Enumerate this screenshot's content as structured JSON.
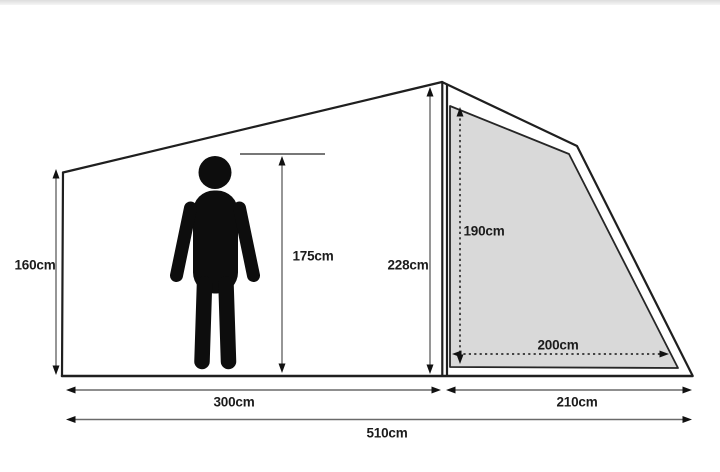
{
  "diagram": {
    "title": "tent-dimension-diagram",
    "colors": {
      "background": "#ffffff",
      "outline": "#1f1f1f",
      "panel_fill": "#d9d9d9",
      "measure_line": "#6a6a6a",
      "arrowhead": "#111111",
      "text": "#1c1c1c"
    },
    "measurements": {
      "left_wall_height": "160cm",
      "person_height": "175cm",
      "peak_height": "228cm",
      "porch_door_height": "190cm",
      "porch_door_width": "200cm",
      "main_section_length": "300cm",
      "porch_section_length": "210cm",
      "total_length": "510cm"
    }
  }
}
